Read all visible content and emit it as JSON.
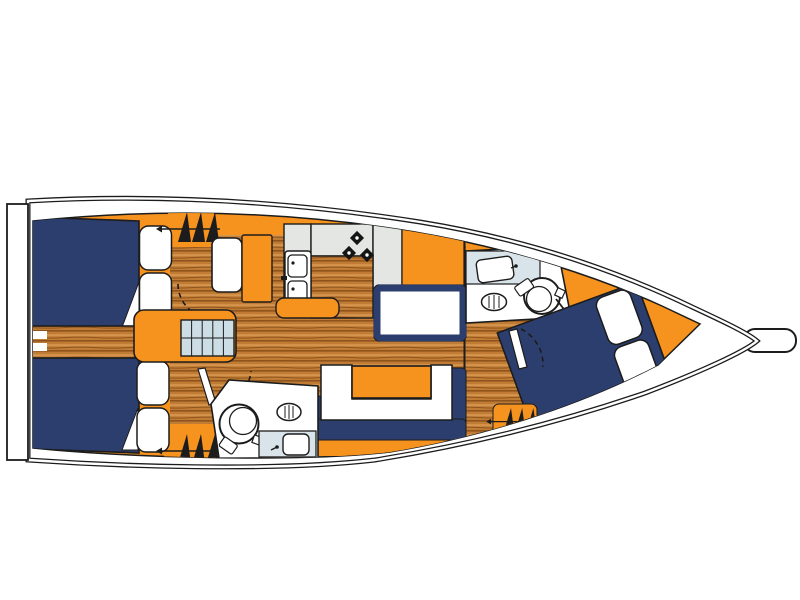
{
  "diagram": {
    "type": "sailboat-interior-floor-plan",
    "orientation": "bow-right-stern-left"
  },
  "palette": {
    "bg": "#ffffff",
    "outline": "#1c1c1c",
    "orange": "#F6921E",
    "navy": "#2c3e6d",
    "wood-light": "#d6954e",
    "wood-mid": "#c07c34",
    "wood-dark": "#8f541c",
    "step-blue": "#ccdde6",
    "counter-gray": "#e4e6e3",
    "head-blue": "#d9e4ea",
    "white": "#ffffff"
  },
  "features": [
    {
      "id": "hull",
      "label": "hull outline with side decks"
    },
    {
      "id": "transom",
      "label": "stern swim platform"
    },
    {
      "id": "bow-roller",
      "label": "bow anchor roller"
    },
    {
      "id": "aft-cabin-port",
      "label": "aft double cabin (top) with berth and pillows"
    },
    {
      "id": "aft-cabin-starboard",
      "label": "aft double cabin (bottom) with berth and pillows"
    },
    {
      "id": "engine-corridor",
      "label": "corridor between aft berths with steps"
    },
    {
      "id": "companionway-stairs",
      "label": "companionway entry steps"
    },
    {
      "id": "galley",
      "label": "galley with double sink, stove and counters"
    },
    {
      "id": "nav-seat",
      "label": "navigation seat / chart bench"
    },
    {
      "id": "salon-settee",
      "label": "U-shaped salon settee with table"
    },
    {
      "id": "aft-head",
      "label": "aft bathroom with shower, toilet and sink"
    },
    {
      "id": "forward-head",
      "label": "forward bathroom with shower, toilet and sink"
    },
    {
      "id": "forward-cabin",
      "label": "forward V-berth cabin with angled double berth"
    },
    {
      "id": "wardrobe-lockers",
      "label": "hanging locker symbols (3x)"
    },
    {
      "id": "door-swings",
      "label": "dashed door swing arcs"
    }
  ]
}
